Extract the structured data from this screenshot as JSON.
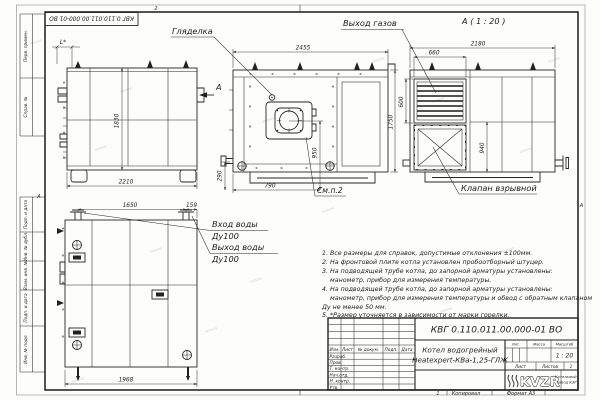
{
  "frame": {
    "stamp": "КВГ 0.110.011.00.000-01 ВО",
    "zone_top": "2",
    "zone_bottom": "1",
    "zone_left": "А",
    "zone_right": "А",
    "copied": "Копировал",
    "format": "Формат А3"
  },
  "margin": {
    "labels": [
      "Перв. примен.",
      "Справ. №",
      "Подп. и дата",
      "Инв. № дубл.",
      "Взам. инв. №",
      "Подп. и дата",
      "Инв. № подл."
    ]
  },
  "views": {
    "side": {
      "dim_top": "L*",
      "dim_height": "1830",
      "dim_width": "2210",
      "view_arrow": "А"
    },
    "front": {
      "dim_width": "2455",
      "dim_height": "1750",
      "dim_burner_v": "950",
      "dim_burner_h": "790",
      "dim_base": "290",
      "label_peephole": "Гляделка",
      "label_see": "См.п.2"
    },
    "rear": {
      "dim_span": "1650",
      "dim_offset": "159",
      "dim_width": "1968",
      "label_in": "Вход воды",
      "label_in_dn": "Ду100",
      "label_out": "Выход воды",
      "label_out_dn": "Ду100"
    },
    "section_a": {
      "title": "А ( 1 : 20 )",
      "dim_width": "2180",
      "dim_grille_w": "660",
      "dim_grille_h": "600",
      "dim_valve": "940",
      "label_gas": "Выход газов",
      "label_valve": "Клапан взрывной"
    }
  },
  "notes": {
    "lines": [
      "1. Все размеры для справок, допустимые отклонения ±100мм.",
      "2. На фронтовой плите котла установлен пробоотборный штуцер.",
      "3. На подводящей трубе котла, до запорной арматуры установлены:",
      "манометр, прибор для измерения температуры.",
      "4. На подводящей трубе котла, до запорной арматуры установлены:",
      "манометр, прибор для измерения температуры и обвод с обратным клапаном",
      "Ду не менее 50 мм.",
      "5. *Размер уточняется в зависимости от марки горелки."
    ]
  },
  "title_block": {
    "designation": "КВГ 0.110.011.00.000-01 ВО",
    "product_line1": "Котел водогрейный",
    "product_line2": "Heatexpert-КВа-1,25-ГЛЖ",
    "cols": [
      "Изм.",
      "Лист",
      "№ докум.",
      "Подп.",
      "Дата"
    ],
    "rows": [
      "Разраб.",
      "Пров.",
      "Т. контр.",
      "Нач.отд.",
      "Н. контр.",
      "Утв."
    ],
    "lit": "Лит.",
    "mass": "Масса",
    "scale": "Масштаб",
    "scale_value": "1 : 20",
    "sheet": "Лист",
    "sheets": "Листов",
    "sheets_value": "1",
    "logo": "KVZR",
    "company1": "Котельный",
    "company2": "завод КЗР"
  }
}
